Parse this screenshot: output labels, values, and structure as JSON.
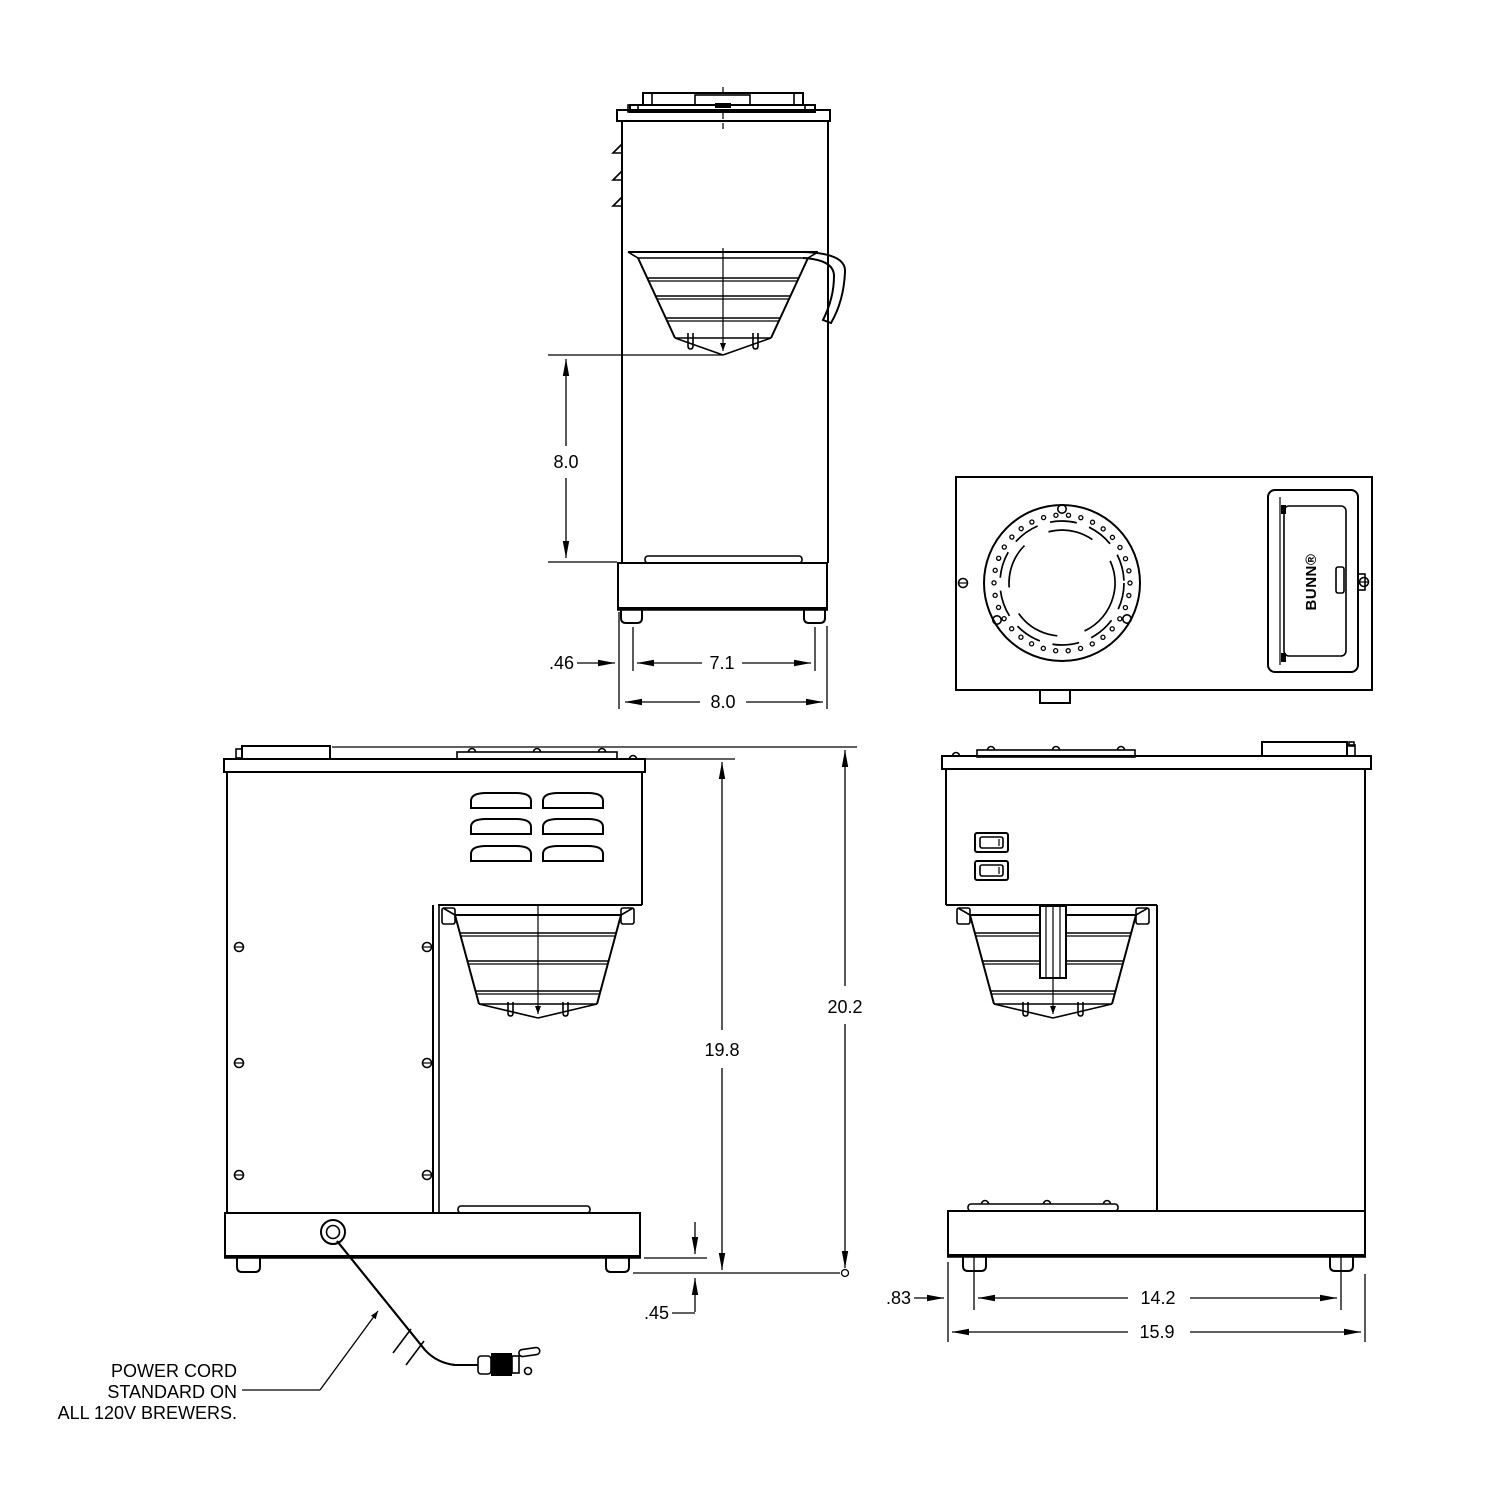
{
  "drawing": {
    "side_view": {
      "dim_funnel_clearance": "8.0",
      "dim_leg_inset": ".46",
      "dim_leg_spacing": "7.1",
      "dim_depth": "8.0"
    },
    "top_view": {
      "brand_label": "BUNN®"
    },
    "rear_view": {
      "dim_body_height": "19.8",
      "dim_overall_height": "20.2",
      "dim_leg_height": ".45",
      "note_line1": "POWER CORD",
      "note_line2": "STANDARD ON",
      "note_line3": "ALL 120V BREWERS."
    },
    "front_view": {
      "dim_leg_inset": ".83",
      "dim_leg_spacing": "14.2",
      "dim_width": "15.9"
    }
  }
}
